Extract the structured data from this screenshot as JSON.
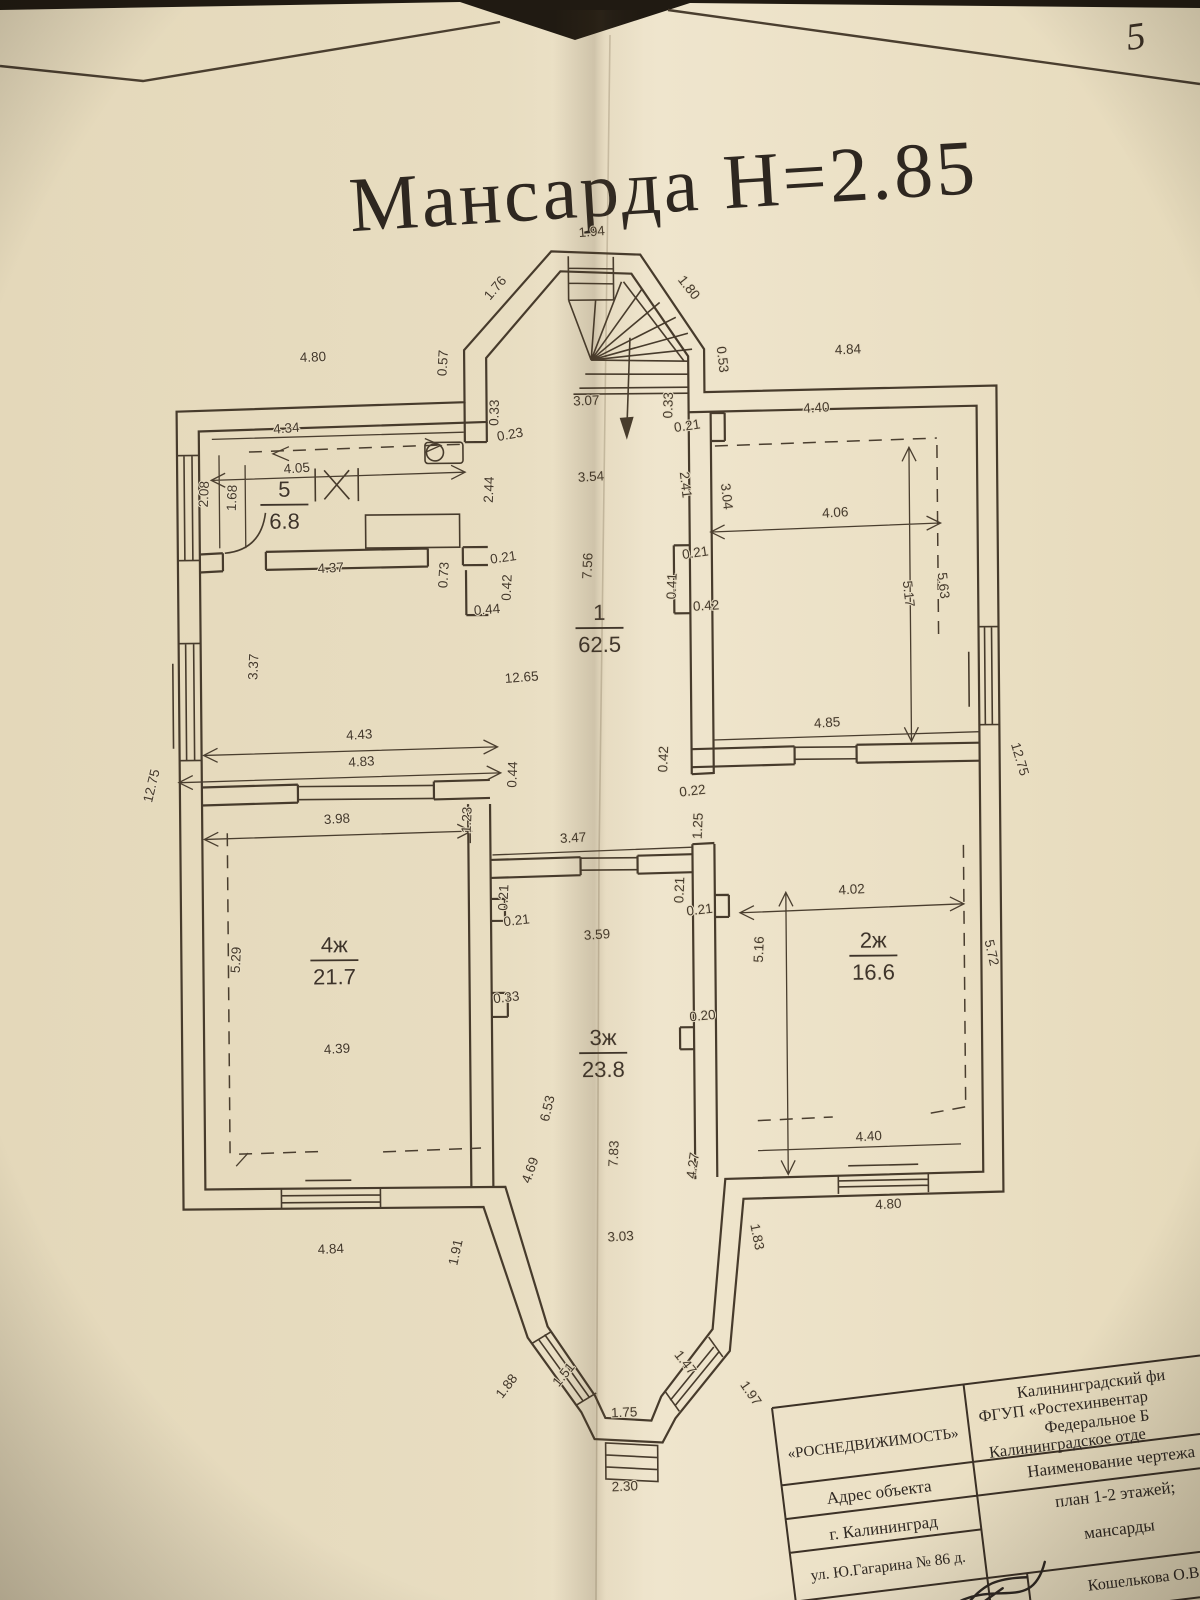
{
  "page": {
    "number": "5"
  },
  "title": {
    "text": "Мансарда  Н=2.85"
  },
  "floor_plan": {
    "rooms": [
      {
        "num": "5",
        "area": "6.8",
        "x": 287,
        "y": 494
      },
      {
        "num": "1",
        "area": "62.5",
        "x": 601,
        "y": 620
      },
      {
        "num": "4ж",
        "area": "21.7",
        "x": 333,
        "y": 950
      },
      {
        "num": "3ж",
        "area": "23.8",
        "x": 601,
        "y": 1045
      },
      {
        "num": "2ж",
        "area": "16.6",
        "x": 872,
        "y": 950
      }
    ],
    "dimensions": [
      {
        "t": "1.94",
        "x": 597,
        "y": 236,
        "r": -4
      },
      {
        "t": "1.76",
        "x": 503,
        "y": 290,
        "r": -49
      },
      {
        "t": "1.80",
        "x": 690,
        "y": 291,
        "r": 52
      },
      {
        "t": "0.57",
        "x": 451,
        "y": 362,
        "r": -86
      },
      {
        "t": "4.80",
        "x": 317,
        "y": 359,
        "r": -2
      },
      {
        "t": "0.53",
        "x": 722,
        "y": 361,
        "r": 84
      },
      {
        "t": "4.84",
        "x": 852,
        "y": 356,
        "r": -2
      },
      {
        "t": "3.07",
        "x": 590,
        "y": 405,
        "r": -2
      },
      {
        "t": "0.33",
        "x": 502,
        "y": 412,
        "r": -88
      },
      {
        "t": "0.23",
        "x": 514,
        "y": 438,
        "r": -10
      },
      {
        "t": "0.33",
        "x": 676,
        "y": 406,
        "r": -88
      },
      {
        "t": "0.21",
        "x": 691,
        "y": 431,
        "r": -8
      },
      {
        "t": "4.34",
        "x": 290,
        "y": 430,
        "r": -4
      },
      {
        "t": "4.05",
        "x": 300,
        "y": 470,
        "r": -4
      },
      {
        "t": "2.08",
        "x": 211,
        "y": 491,
        "r": -87
      },
      {
        "t": "1.68",
        "x": 239,
        "y": 495,
        "r": -87
      },
      {
        "t": "4.37",
        "x": 333,
        "y": 570,
        "r": -3
      },
      {
        "t": "0.73",
        "x": 450,
        "y": 574,
        "r": -86
      },
      {
        "t": "2.44",
        "x": 496,
        "y": 489,
        "r": -87
      },
      {
        "t": "3.54",
        "x": 594,
        "y": 481,
        "r": -3
      },
      {
        "t": "2.41",
        "x": 684,
        "y": 486,
        "r": 84
      },
      {
        "t": "3.04",
        "x": 725,
        "y": 498,
        "r": 84
      },
      {
        "t": "0.21",
        "x": 506,
        "y": 561,
        "r": -8
      },
      {
        "t": "0.42",
        "x": 513,
        "y": 587,
        "r": -87
      },
      {
        "t": "0.44",
        "x": 489,
        "y": 613,
        "r": -4
      },
      {
        "t": "7.56",
        "x": 594,
        "y": 566,
        "r": -87
      },
      {
        "t": "0.21",
        "x": 698,
        "y": 558,
        "r": -8
      },
      {
        "t": "0.41",
        "x": 678,
        "y": 587,
        "r": -87
      },
      {
        "t": "0.42",
        "x": 708,
        "y": 611,
        "r": -3
      },
      {
        "t": "12.65",
        "x": 523,
        "y": 681,
        "r": -4
      },
      {
        "t": "3.37",
        "x": 259,
        "y": 664,
        "r": -87
      },
      {
        "t": "4.40",
        "x": 820,
        "y": 414,
        "r": -3
      },
      {
        "t": "4.06",
        "x": 838,
        "y": 519,
        "r": -3
      },
      {
        "t": "5.17",
        "x": 906,
        "y": 597,
        "r": 84
      },
      {
        "t": "5.63",
        "x": 941,
        "y": 589,
        "r": 84
      },
      {
        "t": "4.85",
        "x": 828,
        "y": 729,
        "r": -3
      },
      {
        "t": "4.43",
        "x": 360,
        "y": 737,
        "r": -3
      },
      {
        "t": "4.83",
        "x": 362,
        "y": 764,
        "r": -3
      },
      {
        "t": "0.44",
        "x": 517,
        "y": 774,
        "r": -87
      },
      {
        "t": "12.75",
        "x": 156,
        "y": 783,
        "r": -76
      },
      {
        "t": "12.75",
        "x": 1016,
        "y": 764,
        "r": 74
      },
      {
        "t": "0.42",
        "x": 668,
        "y": 760,
        "r": -87
      },
      {
        "t": "0.22",
        "x": 693,
        "y": 796,
        "r": -6
      },
      {
        "t": "1.25",
        "x": 702,
        "y": 827,
        "r": -87
      },
      {
        "t": "3.98",
        "x": 337,
        "y": 821,
        "r": -3
      },
      {
        "t": "1.23",
        "x": 471,
        "y": 819,
        "r": -87
      },
      {
        "t": "3.47",
        "x": 573,
        "y": 842,
        "r": -3
      },
      {
        "t": "0.21",
        "x": 507,
        "y": 897,
        "r": -87
      },
      {
        "t": "0.21",
        "x": 516,
        "y": 924,
        "r": -6
      },
      {
        "t": "0.21",
        "x": 683,
        "y": 891,
        "r": -87
      },
      {
        "t": "0.21",
        "x": 699,
        "y": 915,
        "r": -6
      },
      {
        "t": "4.02",
        "x": 851,
        "y": 896,
        "r": -3
      },
      {
        "t": "5.16",
        "x": 762,
        "y": 951,
        "r": -87
      },
      {
        "t": "5.72",
        "x": 986,
        "y": 957,
        "r": 78
      },
      {
        "t": "0.20",
        "x": 701,
        "y": 1021,
        "r": -5
      },
      {
        "t": "0.33",
        "x": 505,
        "y": 1001,
        "r": -6
      },
      {
        "t": "5.29",
        "x": 239,
        "y": 957,
        "r": -87
      },
      {
        "t": "4.39",
        "x": 335,
        "y": 1051,
        "r": -3
      },
      {
        "t": "3.59",
        "x": 596,
        "y": 939,
        "r": -3
      },
      {
        "t": "6.53",
        "x": 549,
        "y": 1109,
        "r": -76
      },
      {
        "t": "4.69",
        "x": 531,
        "y": 1171,
        "r": -70
      },
      {
        "t": "7.83",
        "x": 615,
        "y": 1154,
        "r": -87
      },
      {
        "t": "4.27",
        "x": 694,
        "y": 1167,
        "r": -81
      },
      {
        "t": "4.40",
        "x": 866,
        "y": 1143,
        "r": -3
      },
      {
        "t": "4.80",
        "x": 885,
        "y": 1211,
        "r": -3
      },
      {
        "t": "3.03",
        "x": 617,
        "y": 1241,
        "r": -3
      },
      {
        "t": "4.84",
        "x": 327,
        "y": 1251,
        "r": -2
      },
      {
        "t": "1.91",
        "x": 456,
        "y": 1252,
        "r": -77
      },
      {
        "t": "1.83",
        "x": 749,
        "y": 1239,
        "r": 79
      },
      {
        "t": "1.51",
        "x": 562,
        "y": 1377,
        "r": -50
      },
      {
        "t": "1.47",
        "x": 677,
        "y": 1366,
        "r": 52
      },
      {
        "t": "1.88",
        "x": 505,
        "y": 1388,
        "r": -52
      },
      {
        "t": "1.97",
        "x": 742,
        "y": 1397,
        "r": 56
      },
      {
        "t": "1.75",
        "x": 619,
        "y": 1417,
        "r": -2
      },
      {
        "t": "2.30",
        "x": 619,
        "y": 1491,
        "r": -2
      }
    ]
  },
  "title_block": {
    "company": "«РОСНЕДВИЖИМОСТЬ»",
    "org_lines": [
      "Калининградский фи",
      "ФГУП «Ростехинвентар",
      "Федеральное Б",
      "Калининградское отде"
    ],
    "address_label": "Адрес объекта",
    "drawing_title_label": "Наименование чертежа",
    "city": "г. Калининград",
    "drawing_line1": "план 1-2 этажей;",
    "street": "ул. Ю.Гагарина № 86 д.",
    "drawing_line2": "мансарды",
    "executor": "Кошелькова О.В."
  }
}
